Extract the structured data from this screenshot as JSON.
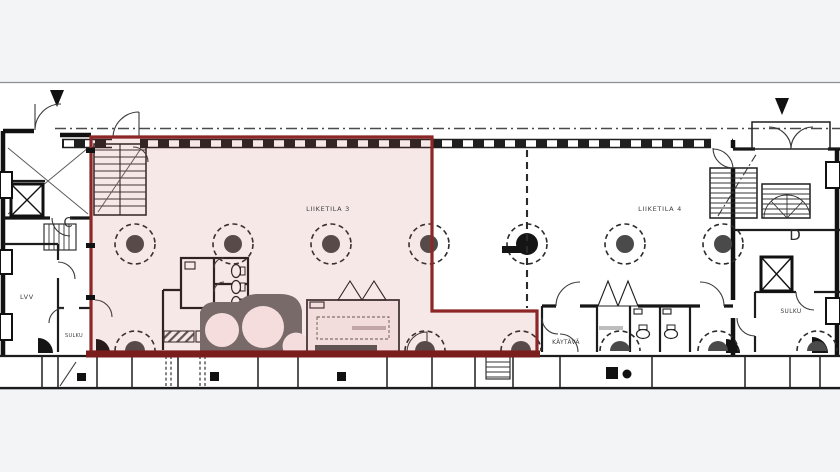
{
  "drawing": {
    "type": "architectural-floor-plan",
    "selection": {
      "highlighted_unit": "LIIKETILA 3"
    },
    "units": {
      "unit3_label": "LIIKETILA 3",
      "unit4_label": "LIIKETILA 4"
    },
    "rooms": {
      "lvv": "LVV",
      "sulku_left": "SULKU",
      "sulku_right": "SULKU",
      "kaytava": "KÄYTÄVÄ"
    },
    "stairwells": {
      "c": "C",
      "d": "D"
    },
    "colors": {
      "background": "#f3f4f6",
      "paper": "#ffffff",
      "ink": "#1f1f1f",
      "highlight_stroke": "#8d2626",
      "highlight_bottom": "#7a1d1d",
      "highlight_fill": "rgba(190,80,80,0.13)",
      "column_fill": "#4a4a4a"
    }
  }
}
